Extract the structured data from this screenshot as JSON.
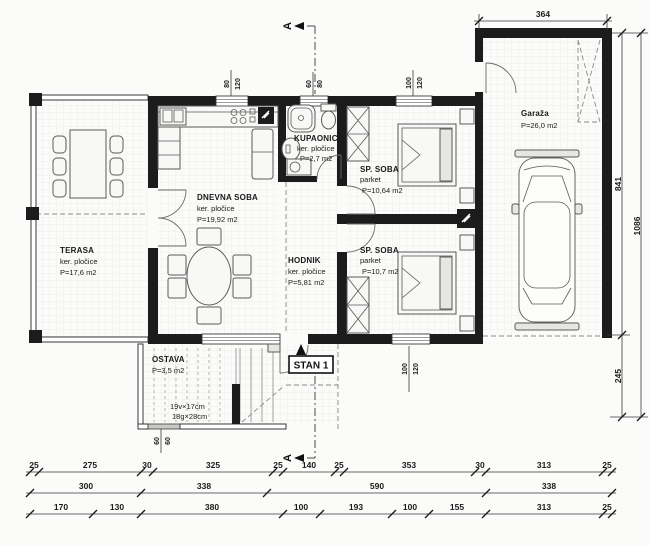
{
  "rooms": {
    "terasa": {
      "name": "TERASA",
      "floor": "ker. pločice",
      "area": "P=17,6 m2"
    },
    "dnevna": {
      "name": "DNEVNA SOBA",
      "floor": "ker. pločice",
      "area": "P=19,92 m2"
    },
    "kupaonica": {
      "name": "KUPAONICA",
      "floor": "ker. pločice",
      "area": "P=2,7 m2"
    },
    "hodnik": {
      "name": "HODNIK",
      "floor": "ker. pločice",
      "area": "P=5,81 m2"
    },
    "sp_soba_1": {
      "name": "SP. SOBA",
      "floor": "parket",
      "area": "P=10,64 m2"
    },
    "sp_soba_2": {
      "name": "SP. SOBA",
      "floor": "parket",
      "area": "P=10,7 m2"
    },
    "ostava": {
      "name": "OSTAVA",
      "area": "P=3,5 m2"
    },
    "garaza": {
      "name": "Garaža",
      "area": "P=26,0 m2"
    }
  },
  "stairs_note": {
    "line1": "19v×17cm",
    "line2": "18g×28cm"
  },
  "entrance": {
    "label": "STAN 1"
  },
  "section": {
    "label": "A"
  },
  "windows": {
    "kitchen": {
      "w": "80",
      "h": "120"
    },
    "bath": {
      "w": "60",
      "h": "80"
    },
    "bedroom1": {
      "w": "100",
      "h": "120"
    },
    "bedroom2": {
      "w": "100",
      "h": "120"
    },
    "ostava": {
      "w": "60",
      "h": "60"
    }
  },
  "dims": {
    "top": "364",
    "right": {
      "garage_depth": "841",
      "lower": "245",
      "total": "1086"
    },
    "row1": [
      "25",
      "275",
      "30",
      "325",
      "25",
      "140",
      "25",
      "353",
      "30",
      "313",
      "25"
    ],
    "row2": [
      "300",
      "338",
      "590",
      "338"
    ],
    "row3": [
      "170",
      "130",
      "380",
      "100",
      "193",
      "100",
      "155",
      "313",
      "25"
    ]
  }
}
